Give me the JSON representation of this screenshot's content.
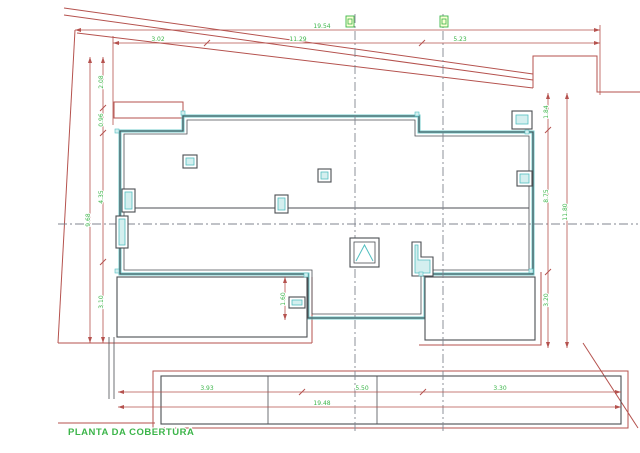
{
  "drawing": {
    "title": "PLANTA DA COBERTURA",
    "dimensions": {
      "top": {
        "total": "19.54",
        "seg1": "3.02",
        "seg2": "11.29",
        "seg3": "5.23"
      },
      "bottom": {
        "total": "19.48",
        "seg1": "3.93",
        "seg2": "5.50",
        "seg3": "3.30"
      },
      "left": {
        "total": "9.68",
        "seg1": "2.08",
        "seg2": "0.96",
        "seg3": "4.35",
        "seg4": "3.10"
      },
      "right": {
        "total": "11.80",
        "seg1": "1.84",
        "seg2": "8.75",
        "seg3": "3.20"
      },
      "detail": {
        "lower_roof": "1.60"
      }
    }
  },
  "colors": {
    "background": "#ffffff",
    "red_line": "#b5524e",
    "green_text": "#3cb54a",
    "building_line": "#4b4e53",
    "teal_line": "#52bfc1",
    "teal_fill": "#d4efef",
    "centerline": "#80858f",
    "stipple_dot": "#85857e",
    "roof_fill": "#f4f4f0",
    "marker_fill": "#fbffd6"
  }
}
